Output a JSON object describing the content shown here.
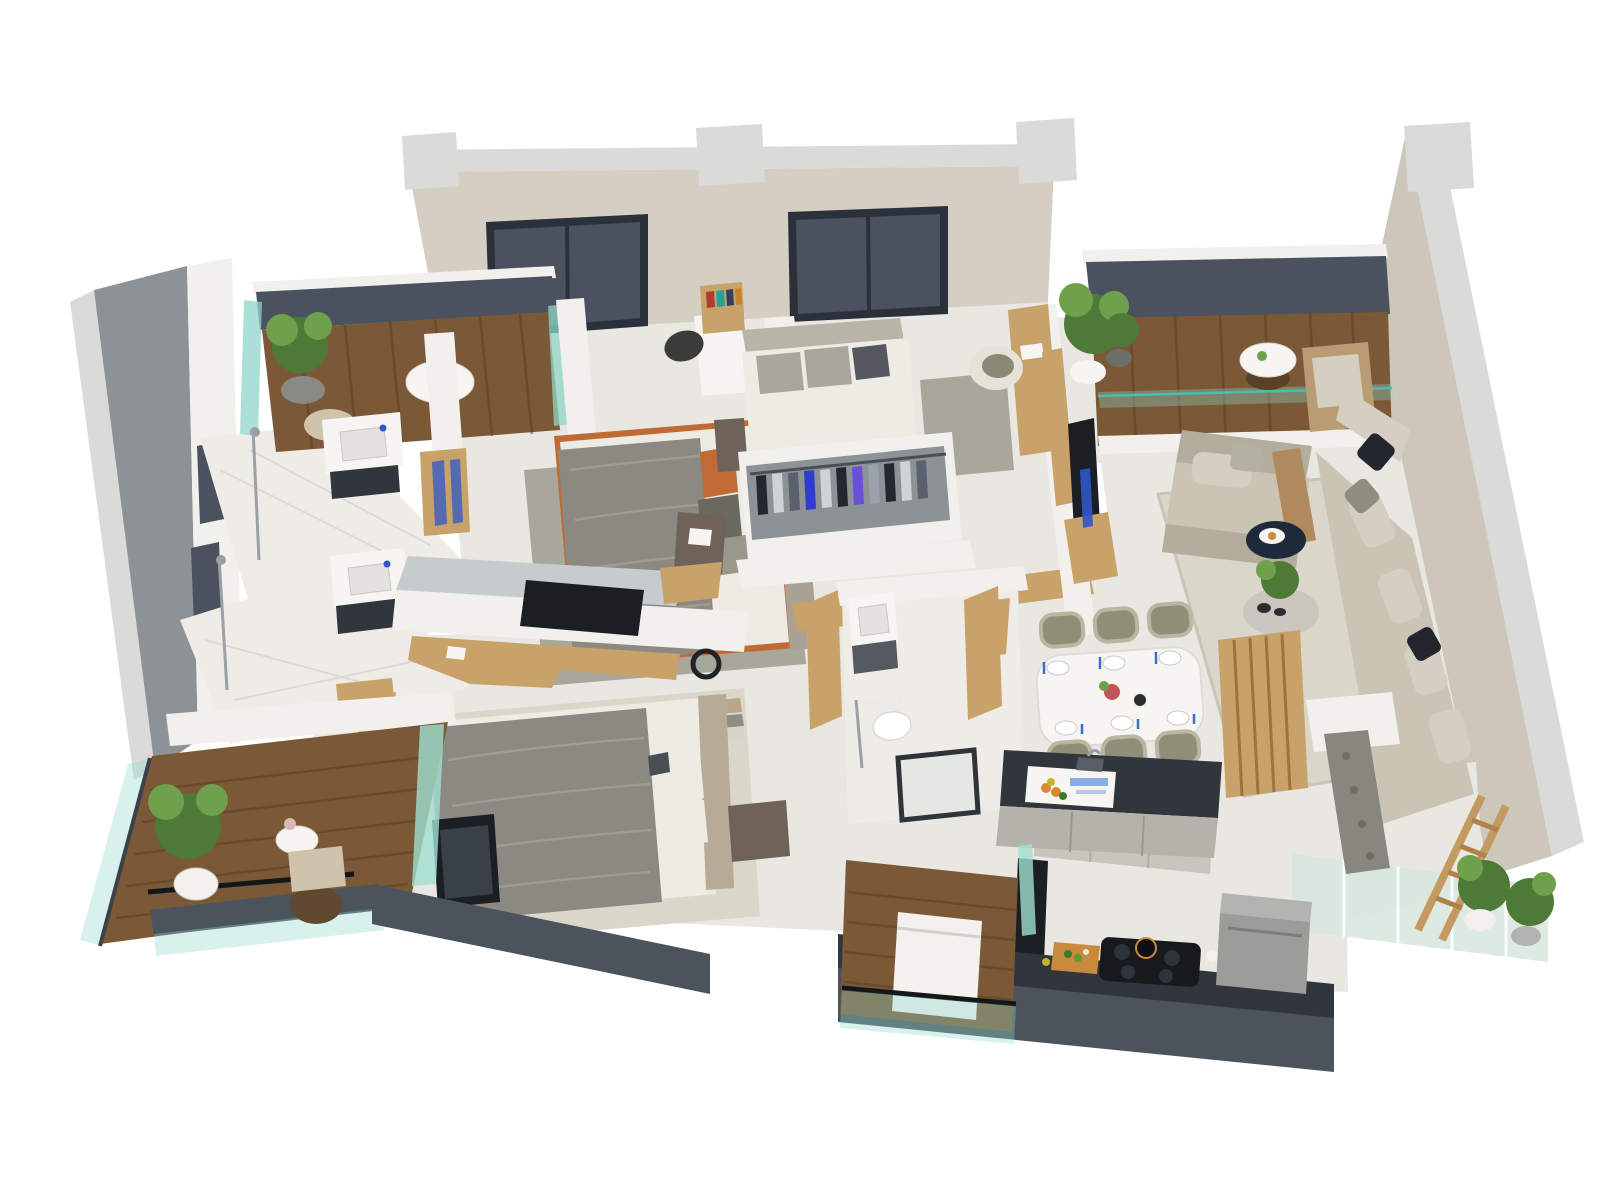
{
  "meta": {
    "description": "Photorealistic 3D isometric dollhouse floor plan render of a 3-bedroom apartment on a white background, viewed from above at an angle",
    "view": "top-down isometric 3D render",
    "background": "#ffffff"
  },
  "palette": {
    "bg": "#ffffff",
    "wall_top": "#dadad8",
    "wall_beige": "#d5cec2",
    "wall_beige_dark": "#cdc6ba",
    "wall_dark": "#8d9297",
    "wall_white": "#f1f0ed",
    "floor_tile": "#e9e7e1",
    "floor_marble": "#efece7",
    "marble_streak": "#d8d4cd",
    "deck_wood": "#7b5836",
    "deck_wood_dark": "#5a4026",
    "oak_wood": "#c8a268",
    "oak_wood_dark": "#9c7440",
    "slate_band": "#4b535c",
    "counter_dark": "#31363c",
    "window_glass": "#49525e",
    "window_frame": "#2b313a",
    "glass_teal": "#8fd6c8",
    "glass_mint": "#9fe0d0",
    "sofa_base": "#c9c4b4",
    "sofa_light": "#d4cfc1",
    "sofa_dark": "#b2ad9d",
    "bed_gray": "#8b8981",
    "bed_white": "#ecebe4",
    "rug_cream": "#dad6c9",
    "rug_gray": "#a8a79b",
    "appliance_gray": "#9c9c98",
    "plant_green": "#4e7a38",
    "plant_green_light": "#6fa04c",
    "navy_table": "#1c2a3c",
    "accent_orange": "#c06b35",
    "accent_blue": "#2f57c8",
    "tv_black": "#1b1f24",
    "chrome": "#9aa0a5"
  },
  "rooms": [
    {
      "name": "master bedroom balcony",
      "floor": "dark wood deck",
      "items": [
        "potted plant",
        "round bistro table",
        "wicker chair",
        "teal glass balustrade"
      ]
    },
    {
      "name": "master bathroom",
      "floor": "white marble",
      "items": [
        "vanity sink",
        "shower",
        "wooden cabinet with blue glass"
      ]
    },
    {
      "name": "second bathroom",
      "floor": "white marble",
      "items": [
        "vanity sink",
        "shower column",
        "wooden door"
      ]
    },
    {
      "name": "master bedroom",
      "floor": "light tile",
      "items": [
        "double bed with gray duvet and orange pillows",
        "area rug",
        "desk and chair",
        "bookshelf",
        "TV console",
        "nightstand"
      ]
    },
    {
      "name": "bedroom two",
      "floor": "light tile",
      "items": [
        "double bed with white duvet",
        "open wardrobe with hanging clothes",
        "desk",
        "rug"
      ]
    },
    {
      "name": "foyer",
      "floor": "light tile",
      "items": [
        "wooden console",
        "round lounge chair",
        "TV panel"
      ]
    },
    {
      "name": "living room balcony",
      "floor": "dark wood deck",
      "items": [
        "round white table",
        "wicker lounge chair",
        "potted plants",
        "glass balustrade"
      ]
    },
    {
      "name": "living room",
      "floor": "light tile",
      "items": [
        "L-shaped sectional sofa",
        "navy round coffee table",
        "gray round coffee table",
        "cream rug",
        "wall TV",
        "wood slat screen"
      ]
    },
    {
      "name": "dining area",
      "floor": "light tile",
      "items": [
        "white dining table",
        "six upholstered chairs",
        "place settings",
        "flower centerpiece"
      ]
    },
    {
      "name": "kitchen",
      "floor": "light tile",
      "items": [
        "island with sink",
        "fruit graphic panel",
        "gas hob",
        "cutting board",
        "tall oven column",
        "gray appliance"
      ]
    },
    {
      "name": "common bathroom",
      "floor": "light marble",
      "items": [
        "sink",
        "toilet",
        "glass shower",
        "wooden half walls"
      ]
    },
    {
      "name": "utility balcony",
      "floor": "dark wood deck",
      "items": [
        "washing machine",
        "glass railing"
      ]
    },
    {
      "name": "bedroom three",
      "floor": "light tile",
      "items": [
        "double bed with gray duvet",
        "striped rug",
        "nightstand",
        "floor TV frame",
        "ring lamp"
      ]
    },
    {
      "name": "bedroom three balcony",
      "floor": "dark wood deck",
      "items": [
        "potted plant",
        "round table",
        "wicker barrel chair",
        "glass balustrade"
      ]
    },
    {
      "name": "side drying balcony",
      "floor": "glass tiles",
      "items": [
        "two potted plants",
        "wooden drying rack",
        "gray appliance",
        "patterned runner"
      ]
    }
  ],
  "structure": {
    "windows": 4,
    "wall_pillars": 4,
    "exterior_wall_color_note": "beige faces, light gray tops, dark gray shaded left wall, slate gray plinth bands"
  }
}
